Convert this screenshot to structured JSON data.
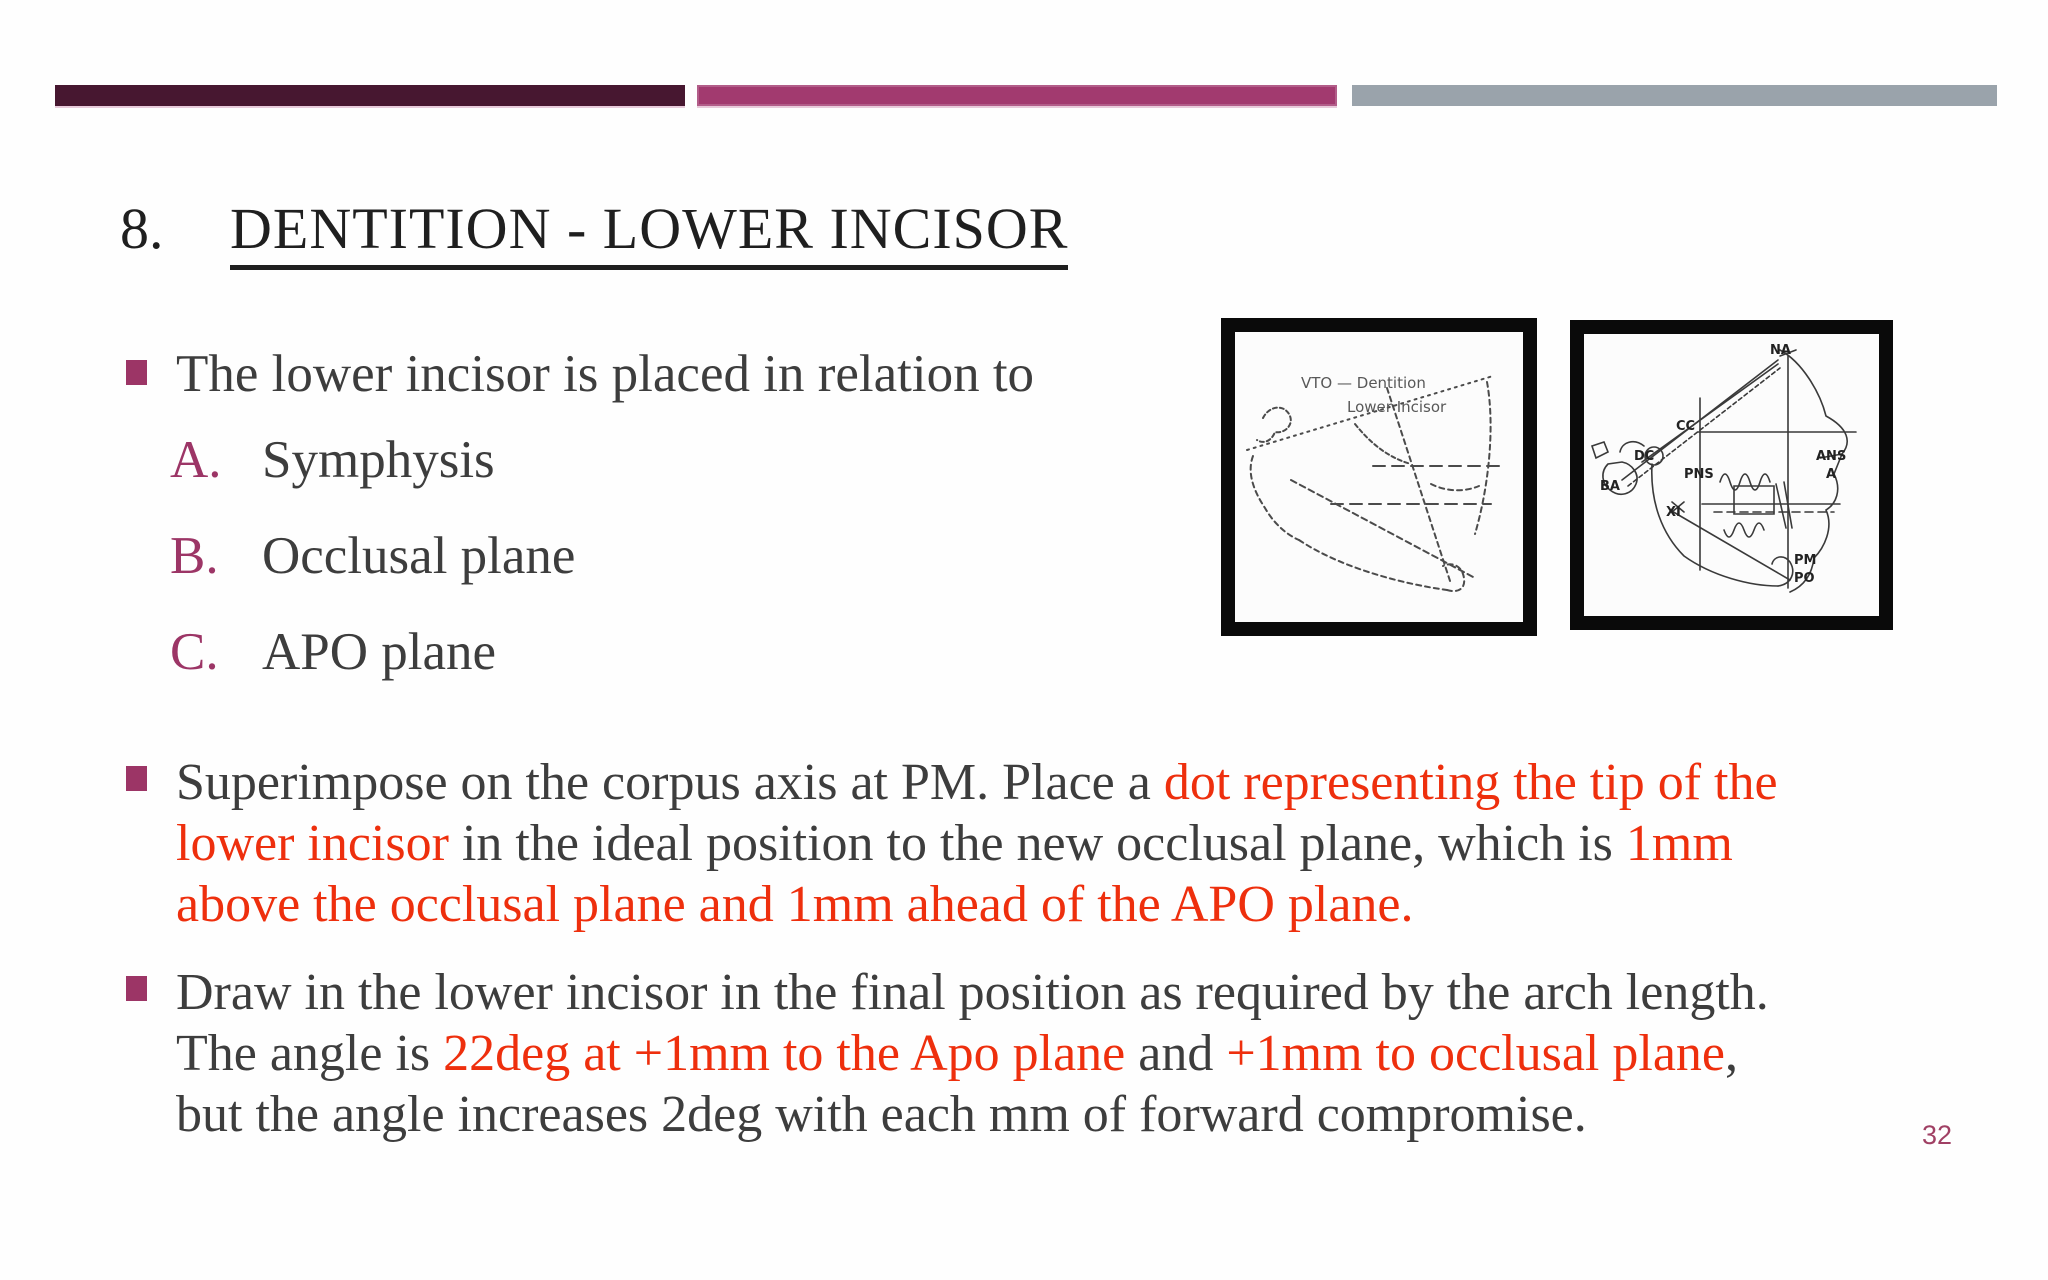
{
  "slide": {
    "accent_bars": [
      {
        "name": "dark-plum",
        "color": "#471730"
      },
      {
        "name": "magenta",
        "color": "#a23a6f"
      },
      {
        "name": "gray",
        "color": "#9aa3ab"
      }
    ],
    "heading": {
      "number": "8.",
      "title": "DENTITION - LOWER INCISOR"
    },
    "intro_bullet": {
      "text": "The lower incisor is placed in relation to"
    },
    "relation_list": [
      {
        "letter": "A.",
        "label": "Symphysis"
      },
      {
        "letter": "B.",
        "label": "Occlusal plane"
      },
      {
        "letter": "C.",
        "label": "APO plane"
      }
    ],
    "superimpose_bullet": {
      "lines": [
        {
          "segments": [
            {
              "text": "Superimpose on the corpus axis at PM. Place a ",
              "style": "dark"
            },
            {
              "text": "dot representing the tip of the",
              "style": "red"
            }
          ]
        },
        {
          "segments": [
            {
              "text": "lower incisor",
              "style": "red"
            },
            {
              "text": " in the ideal position to the new occlusal plane, which is ",
              "style": "dark"
            },
            {
              "text": "1mm",
              "style": "red"
            }
          ]
        },
        {
          "segments": [
            {
              "text": "above the occlusal plane and 1mm ahead of the APO plane.",
              "style": "red"
            }
          ]
        }
      ]
    },
    "draw_bullet": {
      "lines": [
        {
          "segments": [
            {
              "text": "Draw in the lower incisor in the final position as required by the arch length.",
              "style": "dark"
            }
          ]
        },
        {
          "segments": [
            {
              "text": "The angle is ",
              "style": "dark"
            },
            {
              "text": "22deg at +1mm to the Apo plane",
              "style": "red"
            },
            {
              "text": " and ",
              "style": "dark"
            },
            {
              "text": "+1mm to occlusal plane",
              "style": "red"
            },
            {
              "text": ",",
              "style": "dark"
            }
          ]
        },
        {
          "segments": [
            {
              "text": "but the angle increases 2deg with each mm of forward compromise.",
              "style": "dark"
            }
          ]
        }
      ]
    },
    "figures": {
      "left_tracing": {
        "caption_line1": "VTO — Dentition",
        "caption_line2": "Lower Incisor"
      },
      "right_tracing": {
        "labels": [
          {
            "text": "NA"
          },
          {
            "text": "CC"
          },
          {
            "text": "DC"
          },
          {
            "text": "BA"
          },
          {
            "text": "PNS"
          },
          {
            "text": "XI"
          },
          {
            "text": "ANS"
          },
          {
            "text": "A"
          },
          {
            "text": "PM"
          },
          {
            "text": "PO"
          }
        ]
      }
    },
    "page_number": "32",
    "colors": {
      "text_dark": "#3d3d3d",
      "text_red": "#ee2f0d",
      "heading": "#1f1f1f",
      "accent_magenta": "#9c3566",
      "page_number": "#a04064"
    }
  }
}
